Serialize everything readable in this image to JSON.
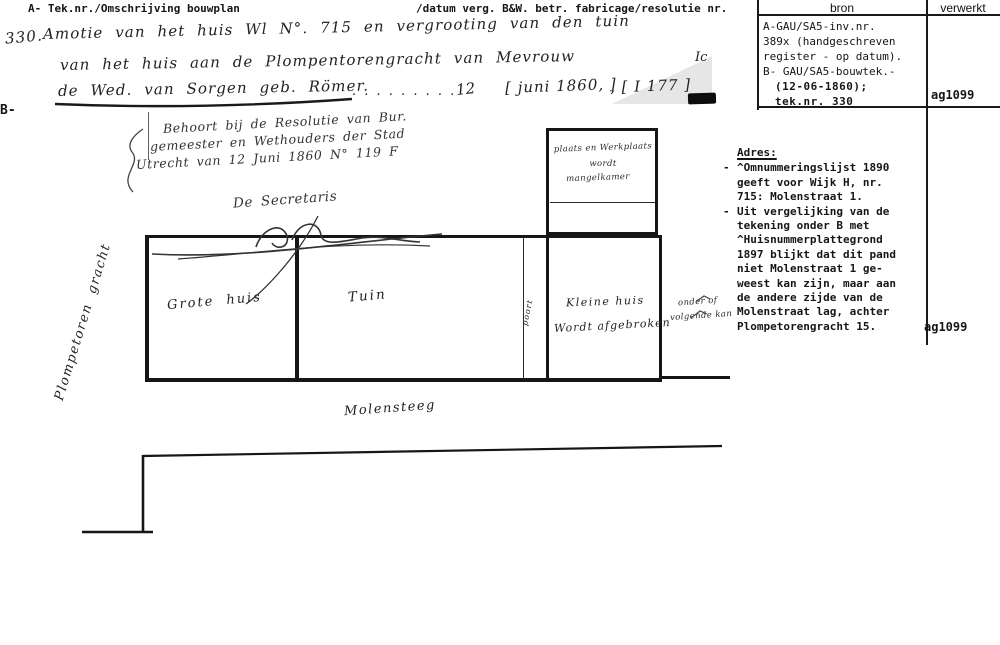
{
  "colors": {
    "ink": "#1a1a1a",
    "ink_soft": "#333333",
    "paper": "#ffffff",
    "shadow": "#e4e4e4"
  },
  "header": {
    "left": "A- Tek.nr./Omschrijving bouwplan",
    "mid": "/datum verg. B&W. betr. fabricage/resolutie nr.",
    "bron": "bron",
    "verwerkt": "verwerkt"
  },
  "entry": {
    "number": "330.",
    "line1": "Amotie van het huis Wl N°. 715 en vergrooting van den tuin",
    "line2": "van het huis aan de Plompentorengracht van Mevrouw",
    "line3": "de Wed. van Sorgen geb. Römer.",
    "leaders": ". . . . . . . . .",
    "day": "12",
    "date": "[ juni 1860, ]",
    "ref": ", [ I 177 ]",
    "corner_note": "Ic",
    "margin_b": "B-"
  },
  "resolution": {
    "line1": "Behoort bij de Resolutie van Bur.",
    "line2": "gemeester en Wethouders der Stad",
    "line3": "Utrecht van 12 Juni 1860 N° 119 F",
    "line4": "De Secretaris"
  },
  "plan": {
    "top_box": [
      "plaats en Werkplaats",
      "wordt",
      "mangelkamer"
    ],
    "grote_huis": "Grote huis",
    "tuin": "Tuin",
    "poort": "poort",
    "kleine_huis": "Kleine huis",
    "kleine_huis_note": "Wordt afgebroken",
    "side_note1": "onder of",
    "side_note2": "volgende kan",
    "street_left": "Plompetoren gracht",
    "street_bottom": "Molensteeg"
  },
  "bron": {
    "lines": [
      "A-GAU/SA5-inv.nr.",
      "389x (handgeschreven",
      "register - op datum).",
      "B- GAU/SA5-bouwtek.-"
    ],
    "bold1": "(12-06-1860);",
    "bold2": "tek.nr. 330",
    "verwerkt": "ag1099"
  },
  "adres": {
    "title": "Adres:",
    "bullet": "-",
    "item1": [
      "^Omnummeringslijst 1890",
      "geeft voor Wijk H, nr.",
      "715: Molenstraat 1."
    ],
    "item2": [
      "Uit vergelijking van de",
      "tekening onder B met",
      "^Huisnummerplattegrond",
      "1897 blijkt dat dit pand",
      "niet Molenstraat 1 ge-",
      "weest kan zijn, maar aan",
      "de andere zijde van de",
      "Molenstraat lag, achter",
      "Plompetorengracht 15."
    ],
    "verwerkt": "ag1099"
  }
}
